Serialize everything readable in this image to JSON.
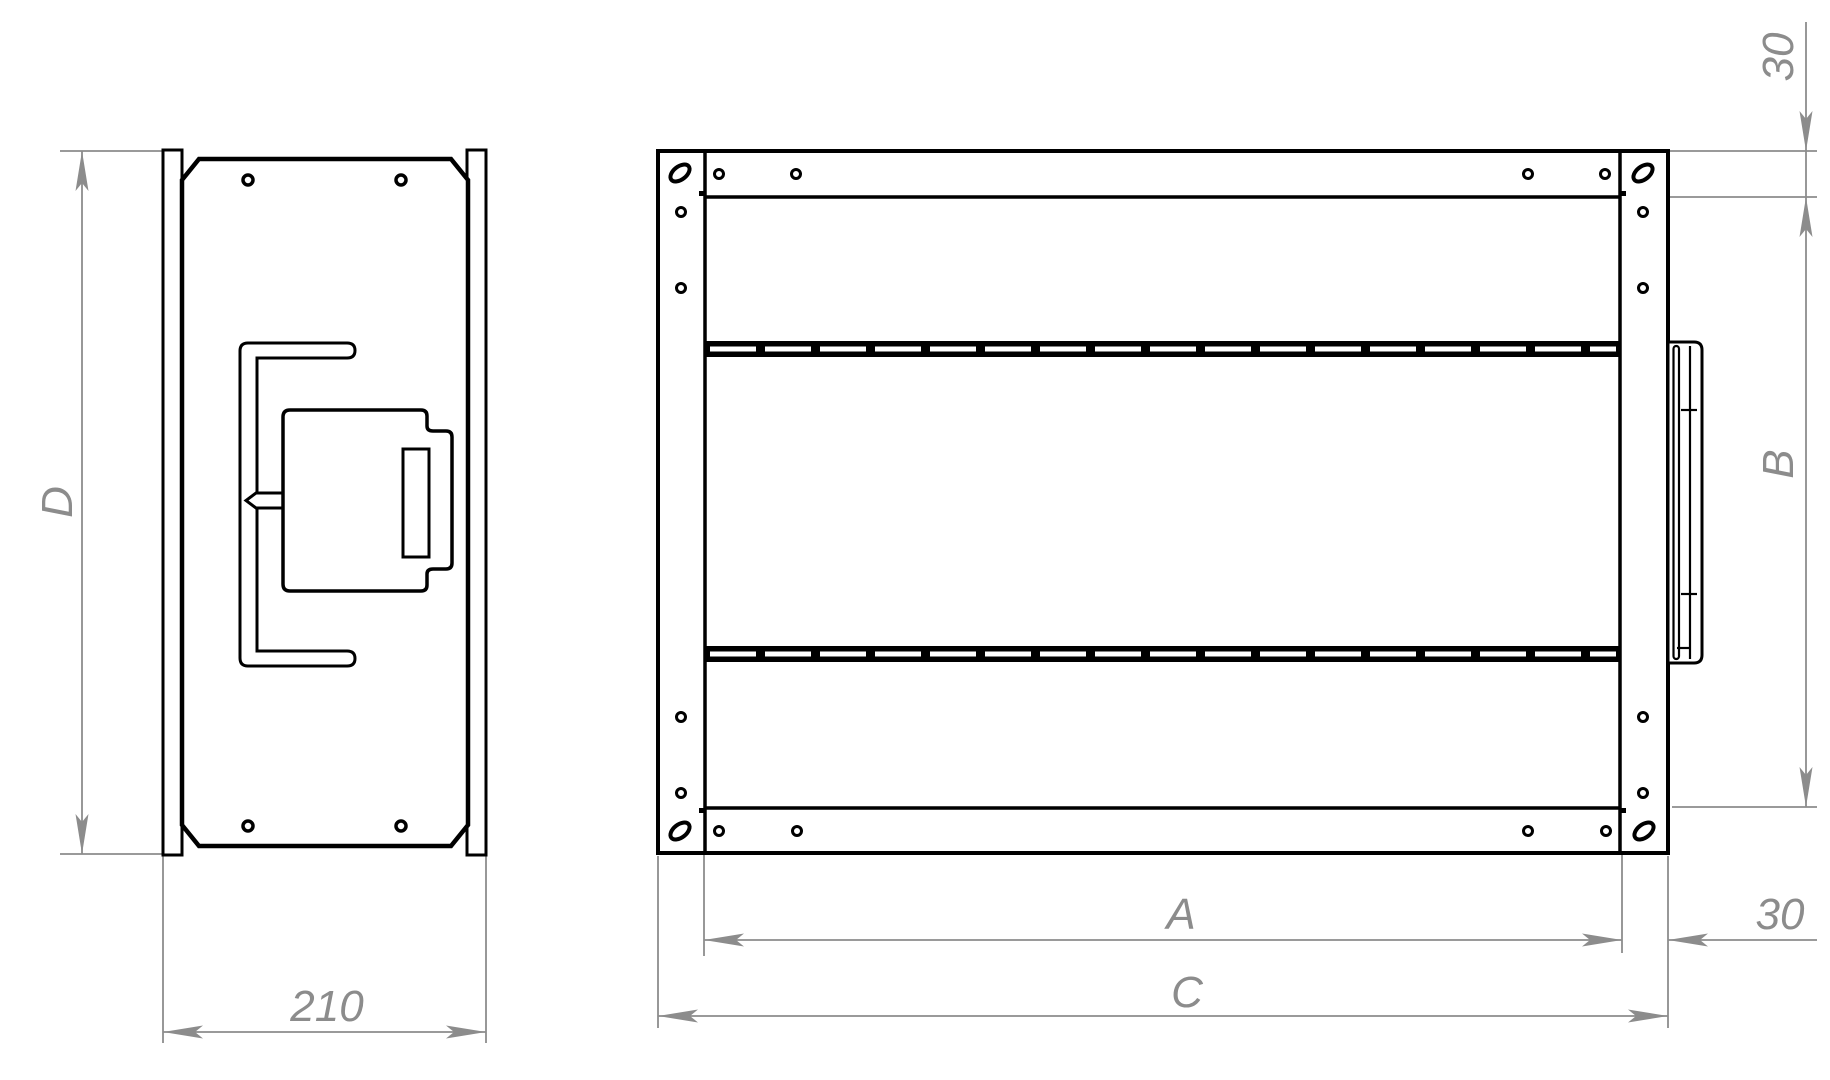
{
  "drawing": {
    "type": "technical-drawing",
    "colors": {
      "line": "#000000",
      "dimension": "#8c8c8c",
      "background": "#ffffff"
    },
    "dimensions": {
      "overall_height": "D",
      "side_width": "210",
      "inner_width": "A",
      "inner_height": "B",
      "overall_width": "C",
      "top_flange": "30",
      "right_flange": "30"
    }
  }
}
